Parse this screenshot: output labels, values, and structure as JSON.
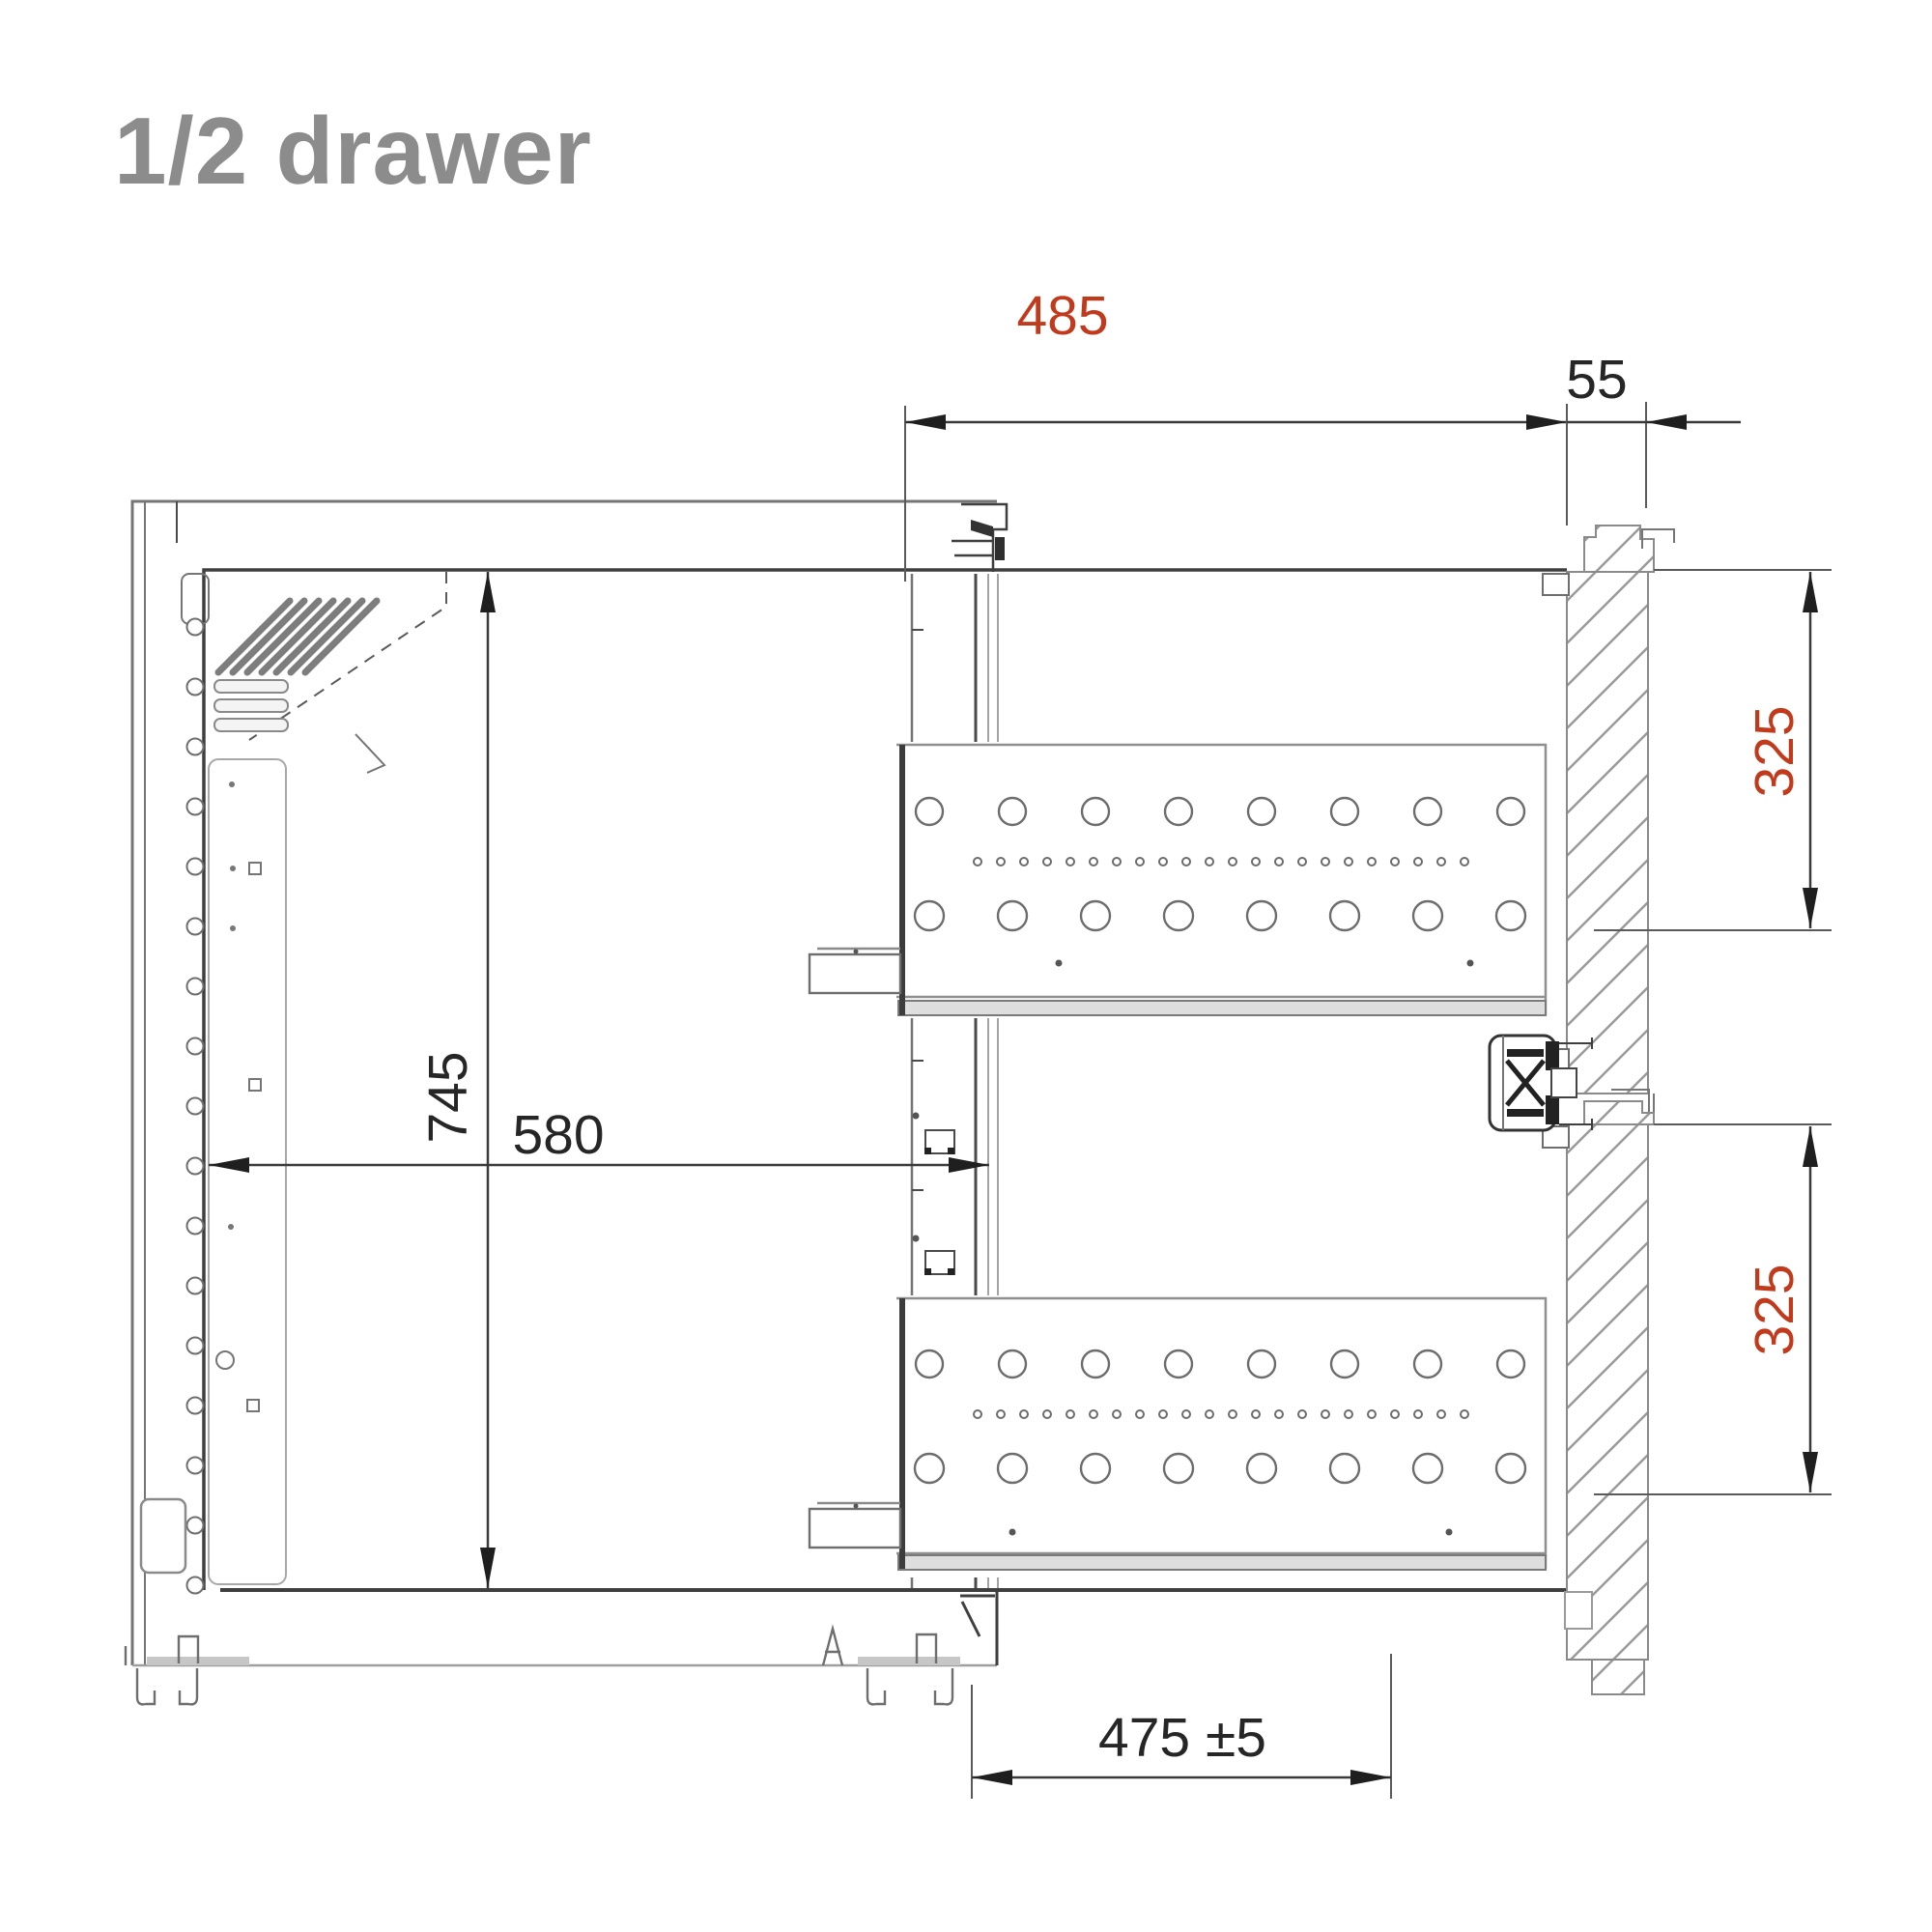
{
  "title": {
    "text": "1/2 drawer"
  },
  "colors": {
    "title": "#8c8c8c",
    "dim_red": "#c23a1c",
    "dim_black": "#262626",
    "line_dark": "#3f3f3f",
    "line_medium": "#757575",
    "line_light": "#a3a3a3"
  },
  "dims": {
    "d485": {
      "value": "485",
      "color": "red"
    },
    "d55": {
      "value": "55",
      "color": "black"
    },
    "d325_top": {
      "value": "325",
      "color": "red"
    },
    "d325_bottom": {
      "value": "325",
      "color": "red"
    },
    "d745": {
      "value": "745",
      "color": "black"
    },
    "d580": {
      "value": "580",
      "color": "black"
    },
    "d475": {
      "value": "475 ±5",
      "color": "black"
    }
  },
  "drawing": {
    "drawers": [
      {
        "name": "top drawer"
      },
      {
        "name": "bottom drawer"
      }
    ],
    "large_holes_per_row": 8,
    "hole_rows_per_drawer": 2,
    "small_holes_per_drawer": 22,
    "screw_holes_count": 17,
    "vent_diagonal_slots": 7,
    "vent_horizontal_slats": 3
  }
}
